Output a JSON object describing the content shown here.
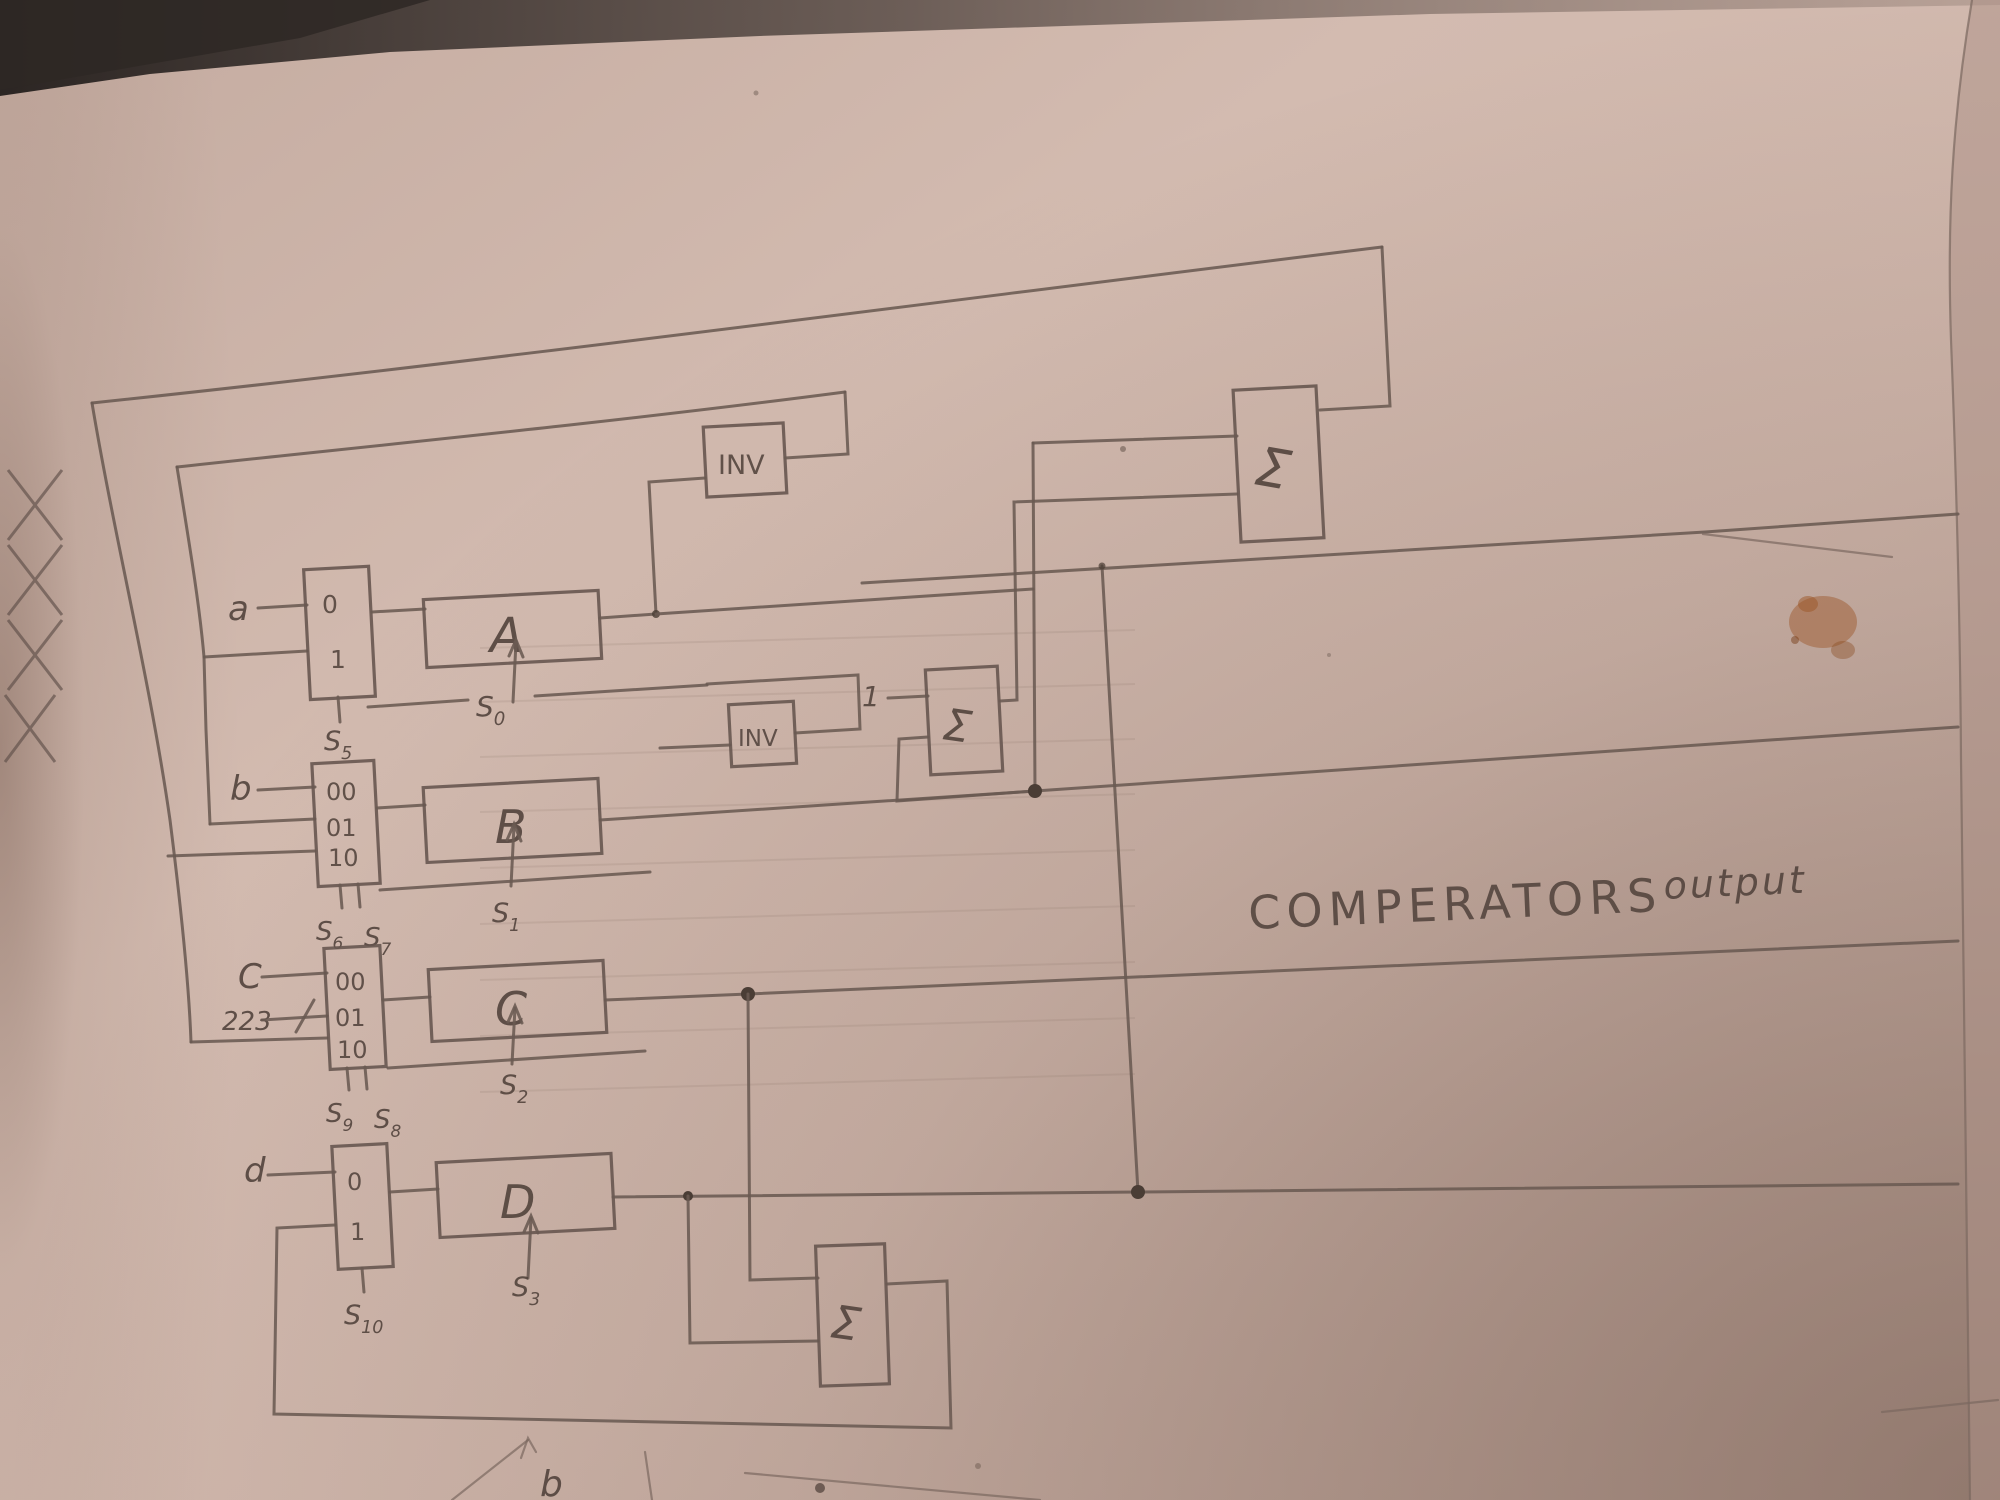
{
  "paper": {
    "background": "#cdb5aa",
    "background_light": "#dcc8bd",
    "background_dark": "#bda59a",
    "pencil": "#6a5a52",
    "dark_pencil": "#4a3d35",
    "stain_color": "#9c5526",
    "shadow": "#2e2825"
  },
  "annotation": {
    "word1": "COMPERATORS",
    "word2": "output"
  },
  "blocks": {
    "a": "A",
    "b": "B",
    "c": "C",
    "d": "D"
  },
  "inverters": {
    "inv1": "INV",
    "inv2": "INV"
  },
  "adders": {
    "top": "Σ",
    "mid": "Σ",
    "bottom": "Σ"
  },
  "inputs": {
    "a": "a",
    "b": "b",
    "c": "C",
    "c_bus": "223",
    "d": "d",
    "one": "1"
  },
  "mux": {
    "a": [
      "0",
      "1"
    ],
    "b": [
      "00",
      "01",
      "10"
    ],
    "c": [
      "00",
      "01",
      "10"
    ],
    "d": [
      "0",
      "1"
    ]
  },
  "selects": {
    "s0": {
      "base": "S",
      "sub": "0"
    },
    "s1": {
      "base": "S",
      "sub": "1"
    },
    "s2": {
      "base": "S",
      "sub": "2"
    },
    "s3": {
      "base": "S",
      "sub": "3"
    },
    "sel_a": {
      "base": "S",
      "sub": "5"
    },
    "sel_b_left": {
      "base": "S",
      "sub": "6"
    },
    "sel_b_right": {
      "base": "S",
      "sub": "7"
    },
    "sel_c_left": {
      "base": "S",
      "sub": "9"
    },
    "sel_c_right": {
      "base": "S",
      "sub": "8"
    },
    "sel_d": {
      "base": "S",
      "sub": "10"
    },
    "bottom_sketch_letter": "b"
  }
}
